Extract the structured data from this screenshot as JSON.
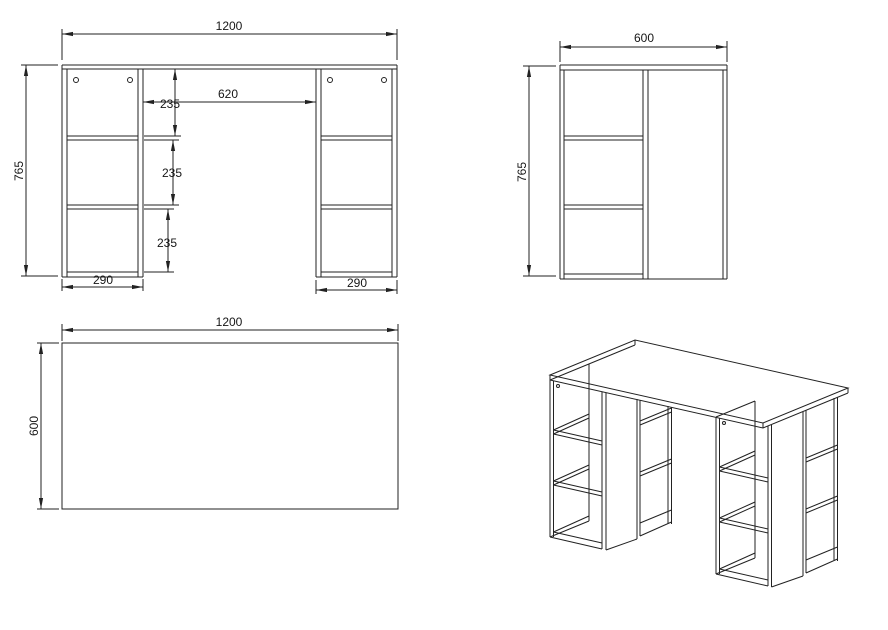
{
  "drawing": {
    "front": {
      "width": "1200",
      "height": "765",
      "gap": "620",
      "spacing_top": "235",
      "spacing_mid": "235",
      "spacing_bottom": "235",
      "pedestal_left_width": "290",
      "pedestal_right_width": "290"
    },
    "side": {
      "depth": "600",
      "height": "765"
    },
    "plan": {
      "width": "1200",
      "depth": "600"
    }
  }
}
